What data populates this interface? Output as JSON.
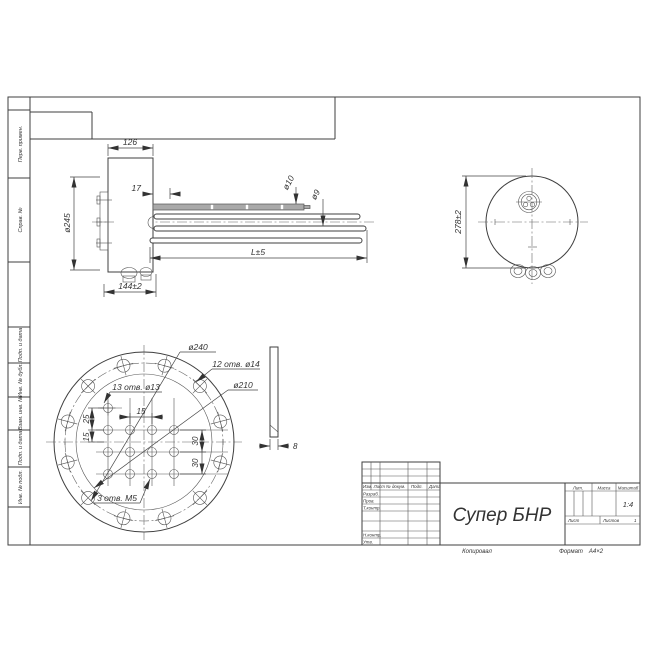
{
  "side_view": {
    "width_dim": "126",
    "offset_dim": "17",
    "flange_dia": "ø245",
    "base_dim": "144±2",
    "length_dim": "L±5",
    "thermowell_dia": "ø10",
    "tube_dia": "ø9"
  },
  "end_view": {
    "outer_dia": "278±2"
  },
  "flange_view": {
    "bolt_circle_dia": "ø240",
    "bolt_holes_note": "12 отв. ø14",
    "inner_circle_dia": "ø210",
    "tube_holes_note": "13 отв. ø13",
    "m5_holes_note": "3 отв. М5",
    "col_spacing": "15",
    "offset_top": "25",
    "offset_mid": "15",
    "row_spacing_1": "30",
    "row_spacing_2": "30",
    "thickness_dim": "8"
  },
  "title_block": {
    "part_name": "Супер БНР",
    "header_izm_list": "Изм. Лист",
    "header_doc": "№ докум.",
    "header_podp": "Подп.",
    "header_data": "Дата",
    "razrab": "Разраб.",
    "prov": "Пров.",
    "tkontr": "Т.контр.",
    "nkontr": "Н.контр.",
    "utv": "Утв.",
    "lit": "Лит.",
    "massa": "Масса",
    "masshtab": "Масштаб",
    "scale_value": "1:4",
    "list_label": "Лист",
    "listov_label": "Листов",
    "listov_value": "1"
  },
  "margin": {
    "perv_primen": "Перв. примен.",
    "sprav_no": "Справ. №",
    "podp_i_data_1": "Подп. и дата",
    "inv_no_dubl": "Инв. № дубл.",
    "vzam_inv_no": "Взам. инв. №",
    "podp_i_data_2": "Подп. и дата",
    "inv_no_podl": "Инв. № подл."
  },
  "footer": {
    "kopiroval": "Копировал",
    "format_label": "Формат",
    "format_value": "А4×2"
  }
}
